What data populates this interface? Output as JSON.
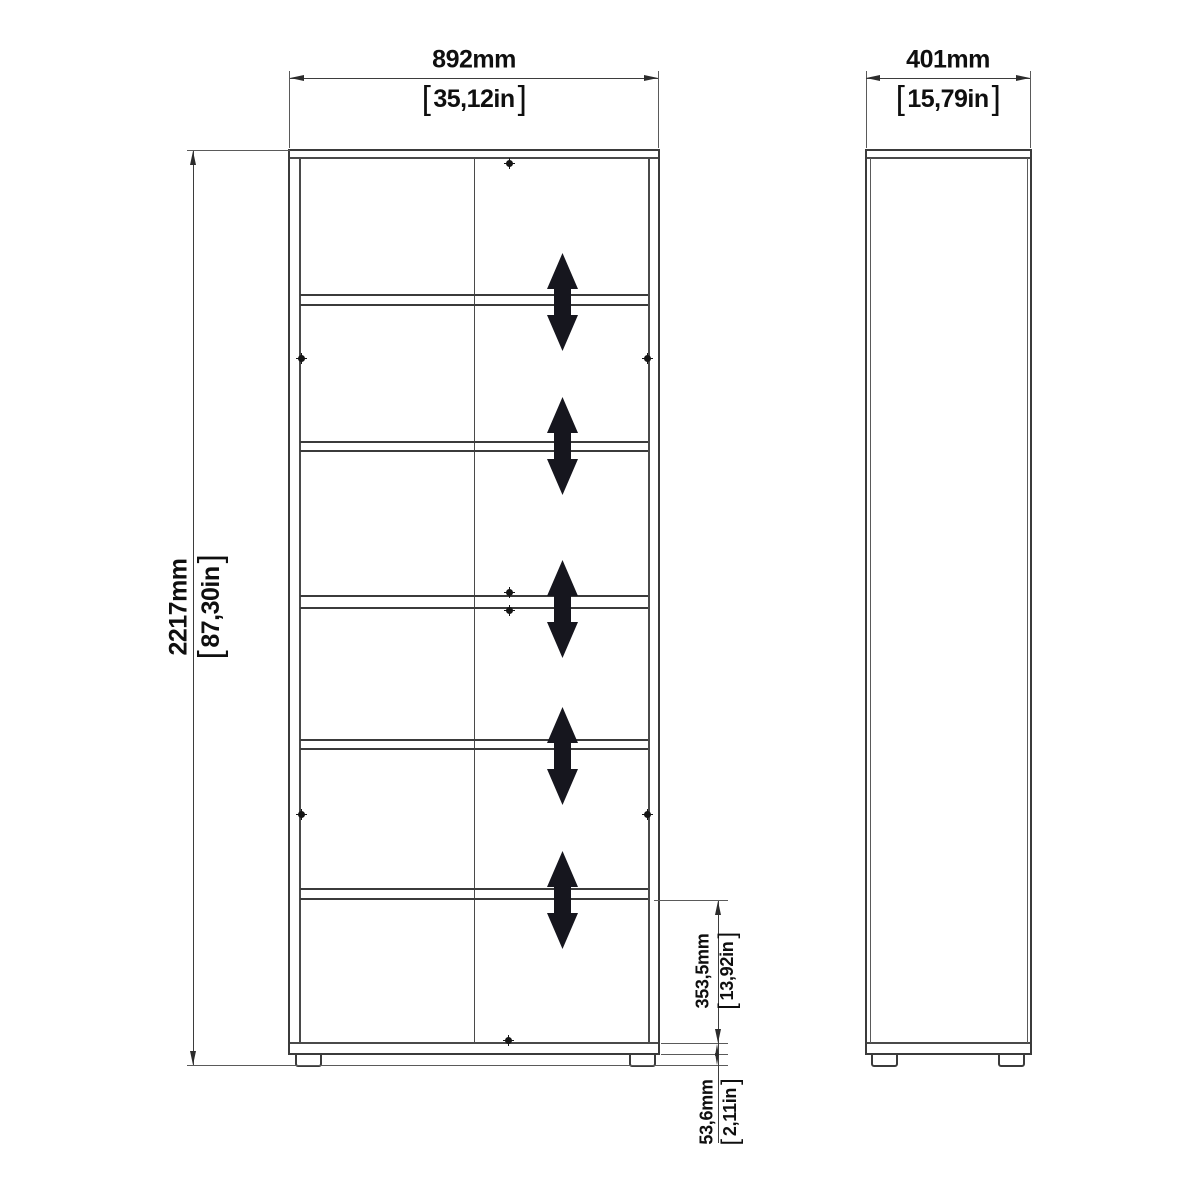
{
  "symbols": {
    "bracket_open": "[",
    "bracket_close": "]"
  },
  "colors": {
    "background": "#ffffff",
    "outline": "#3b3b3b",
    "thin_line": "#5a5a5a",
    "dimension_line": "#3d3d3d",
    "adjust_arrow": "#16161e",
    "text": "#0f0f0f"
  },
  "icons": {
    "adjustable_shelf_arrow": "double-vertical-arrow-icon",
    "cam_screw": "screw-dot-icon"
  },
  "dimensions": {
    "front_width": {
      "mm": "892mm",
      "in": "35,12in"
    },
    "side_depth": {
      "mm": "401mm",
      "in": "15,79in"
    },
    "total_height": {
      "mm": "2217mm",
      "in": "87,30in"
    },
    "bottom_compartment_height": {
      "mm": "353,5mm",
      "in": "13,92in"
    },
    "plinth_height": {
      "mm": "53,6mm",
      "in": "2,11in"
    }
  }
}
